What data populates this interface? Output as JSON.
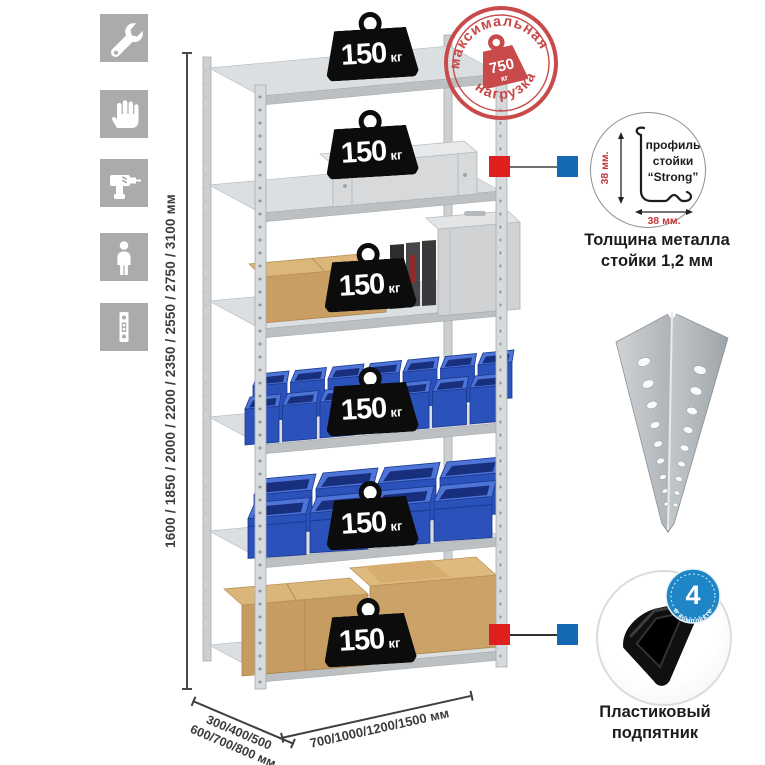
{
  "colors": {
    "stamp_red": "#c84a4a",
    "marker_red": "#e01f1f",
    "marker_blue": "#1569b2",
    "badge_blue": "#1e86c6",
    "bin_blue": "#2b51bb",
    "tile_gray": "#a9abad"
  },
  "left_toolbar": {
    "icons": [
      {
        "name": "wrench-icon"
      },
      {
        "name": "gloves-icon"
      },
      {
        "name": "drill-icon"
      },
      {
        "name": "person-icon"
      },
      {
        "name": "rack-post-icon"
      }
    ]
  },
  "dimensions": {
    "height": {
      "label": "1600 / 1850 / 2000 / 2200 / 2350 / 2550 / 2750 / 3100 мм"
    },
    "depth": {
      "line1": "300/400/500",
      "line2": "600/700/800 мм"
    },
    "width": {
      "label": "700/1000/1200/1500 мм"
    }
  },
  "shelf_load_badges": [
    {
      "value": "150",
      "unit": "кг"
    },
    {
      "value": "150",
      "unit": "кг"
    },
    {
      "value": "150",
      "unit": "кг"
    },
    {
      "value": "150",
      "unit": "кг"
    },
    {
      "value": "150",
      "unit": "кг"
    },
    {
      "value": "150",
      "unit": "кг"
    }
  ],
  "max_load_stamp": {
    "top_text": "максимальная",
    "bottom_text": "нагрузка",
    "value": "750",
    "unit": "кг"
  },
  "profile_detail": {
    "line1": "профиль",
    "line2": "стойки",
    "line3": "“Strong”",
    "dim_vertical": "38 мм.",
    "dim_horizontal": "38 мм.",
    "caption_line1": "Толщина металла",
    "caption_line2": "стойки 1,2 мм"
  },
  "foot_detail": {
    "badge_value": "4",
    "badge_arc_text": "в комплекте",
    "caption_line1": "Пластиковый",
    "caption_line2": "подпятник"
  }
}
